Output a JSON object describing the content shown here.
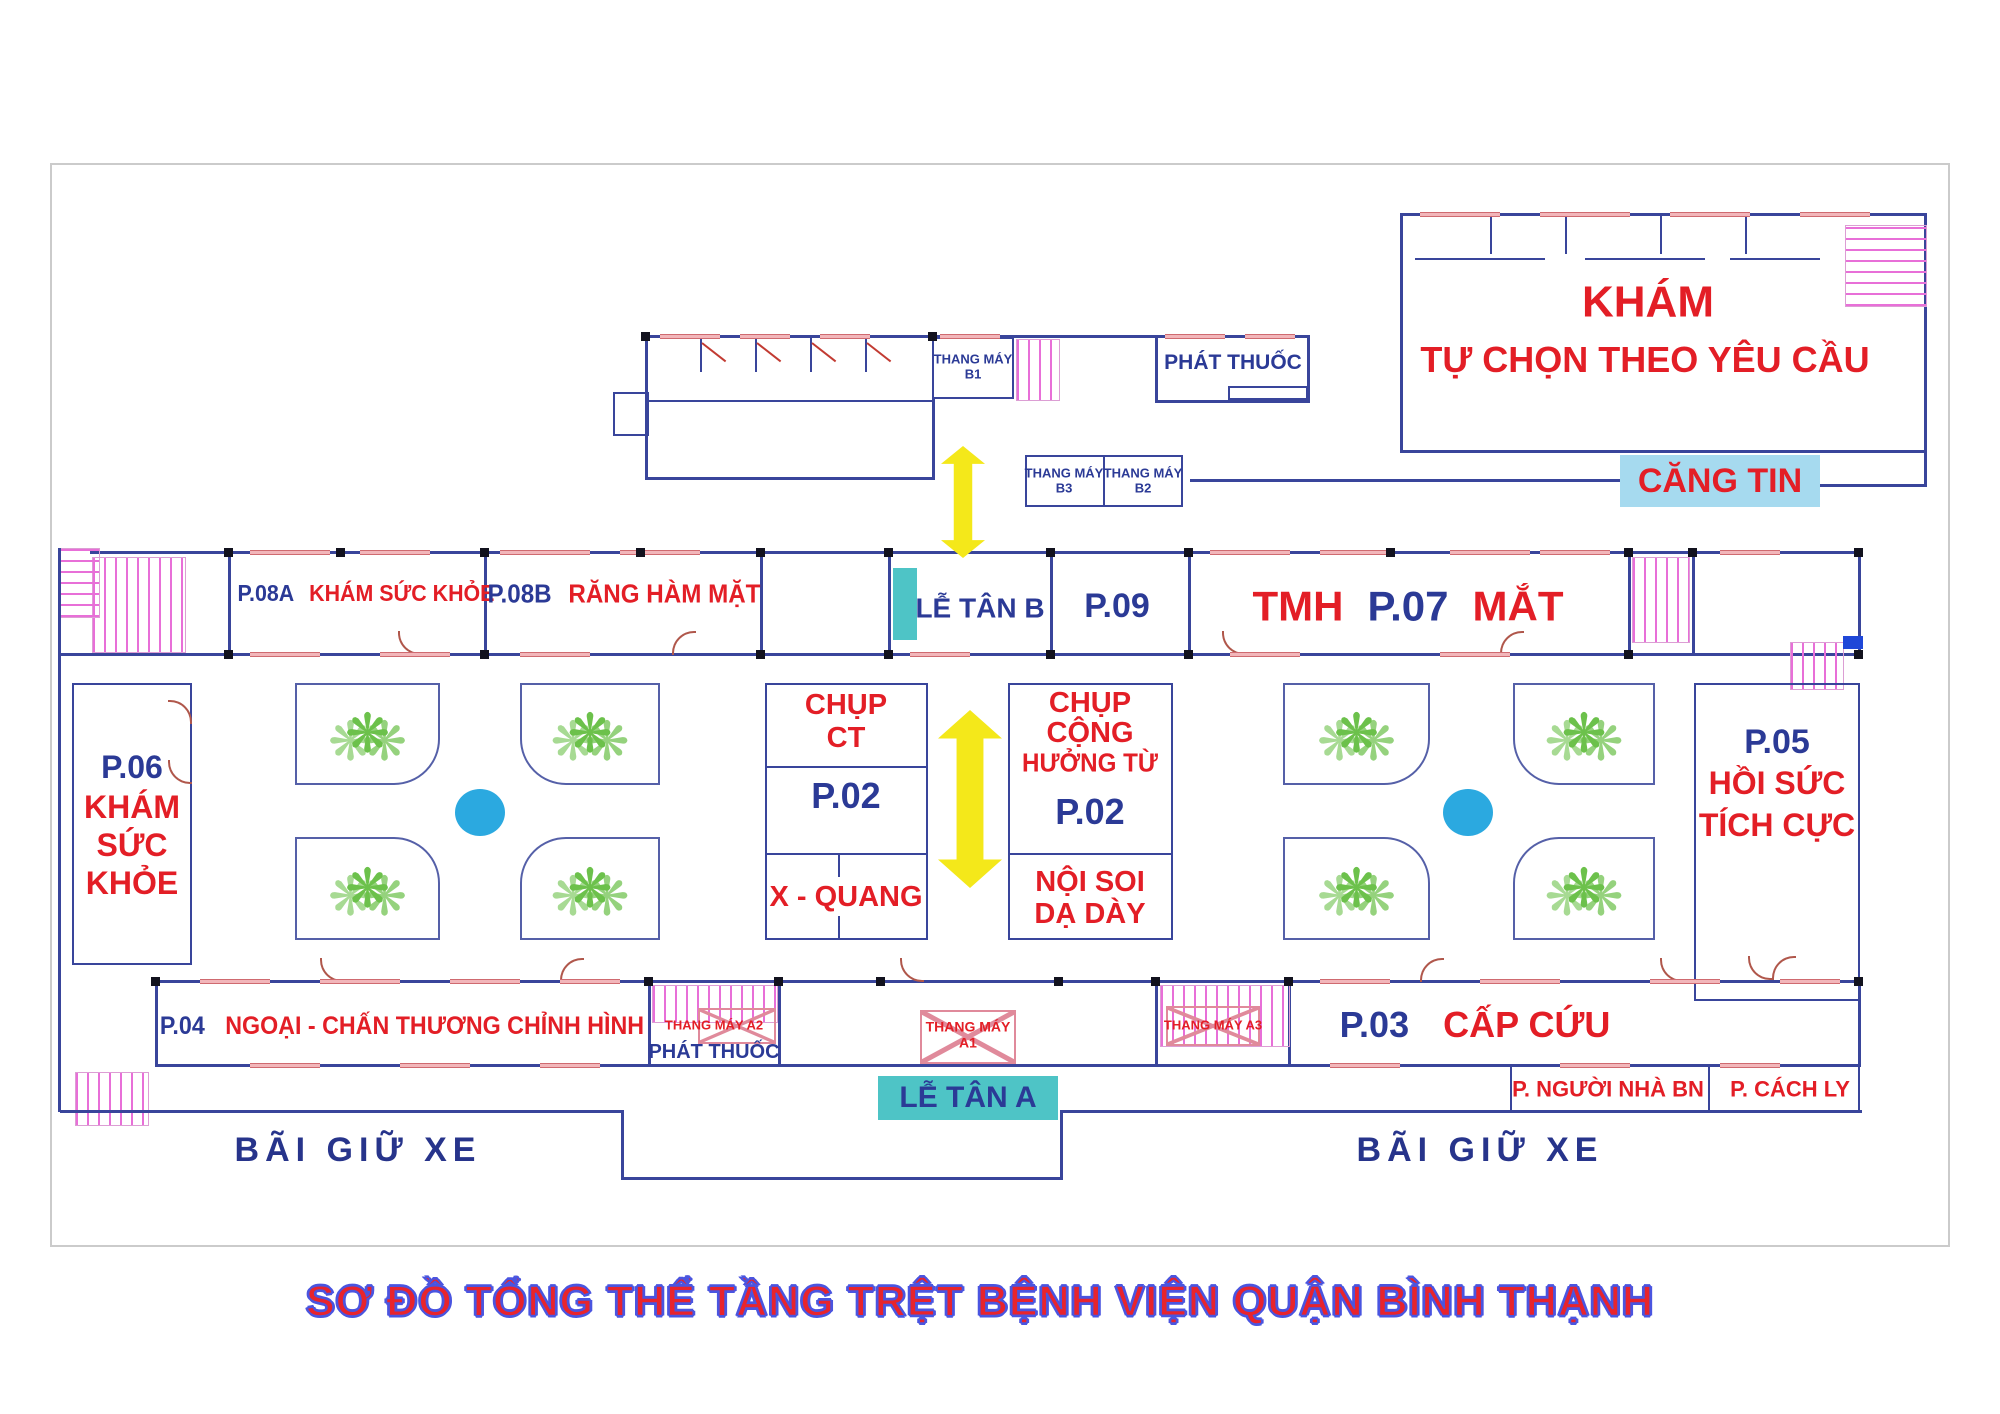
{
  "title": "SƠ ĐỒ TỔNG THỂ TẦNG TRỆT BỆNH VIỆN QUẬN BÌNH THẠNH",
  "colors": {
    "wall_blue": "#39459b",
    "code_blue": "#2b3a96",
    "dept_red": "#e31e26",
    "teal": "#4ec4c6",
    "canteen_bg": "#a6daef",
    "arrow_yellow": "#f4e81a",
    "fountain_blue": "#2ba9e0",
    "plant_green": "#6cc14b",
    "stair_pink": "#e86fd8",
    "parking_blue": "#27348b",
    "title_red": "#e8242c",
    "title_outline": "#4a55e0"
  },
  "north_block": {
    "elevator_b1": {
      "line1": "THANG MÁY",
      "line2": "B1"
    },
    "pharmacy": "PHÁT THUỐC"
  },
  "northeast_wing": {
    "name_line1": "KHÁM",
    "name_line2": "TỰ CHỌN THEO YÊU CẦU",
    "canteen": "CĂNG TIN",
    "elevator_b3": {
      "line1": "THANG MÁY",
      "line2": "B3"
    },
    "elevator_b2": {
      "line1": "THANG MÁY",
      "line2": "B2"
    }
  },
  "clinic_row": {
    "p08a": {
      "code": "P.08A",
      "name": "KHÁM SỨC KHỎE"
    },
    "p08b": {
      "code": "P.08B",
      "name": "RĂNG HÀM MẶT"
    },
    "lobby_b": "LỄ TÂN B",
    "p09": {
      "code": "P.09"
    },
    "p07": {
      "prefix": "TMH",
      "code": "P.07",
      "suffix": "MẮT"
    }
  },
  "west_room": {
    "code": "P.06",
    "line1": "KHÁM",
    "line2": "SỨC",
    "line3": "KHỎE"
  },
  "imaging_block": {
    "line1": "CHỤP",
    "line2": "CT",
    "code": "P.02",
    "xray": "X - QUANG"
  },
  "mri_block": {
    "line1": "CHỤP",
    "line2": "CỘNG",
    "line3": "HƯỞNG TỪ",
    "code": "P.02",
    "endo1": "NỘI SOI",
    "endo2": "DẠ DÀY"
  },
  "east_room": {
    "code": "P.05",
    "line1": "HỒI SỨC",
    "line2": "TÍCH CỰC"
  },
  "south_row": {
    "p04": {
      "code": "P.04",
      "name": "NGOẠI - CHẤN THƯƠNG CHỈNH HÌNH"
    },
    "elevator_a2": "THANG MÁY A2",
    "pharmacy": "PHÁT THUỐC",
    "elevator_a1": {
      "line1": "THANG MÁY",
      "line2": "A1"
    },
    "elevator_a3": "THANG MÁY A3",
    "p03": {
      "code": "P.03",
      "name": "CẤP CỨU"
    },
    "lobby_a": "LỄ TÂN A",
    "family_room": "P. NGƯỜI NHÀ BN",
    "isolation_room": "P. CÁCH LY"
  },
  "parking": {
    "left": "BÃI GIỮ XE",
    "right": "BÃI GIỮ XE"
  }
}
